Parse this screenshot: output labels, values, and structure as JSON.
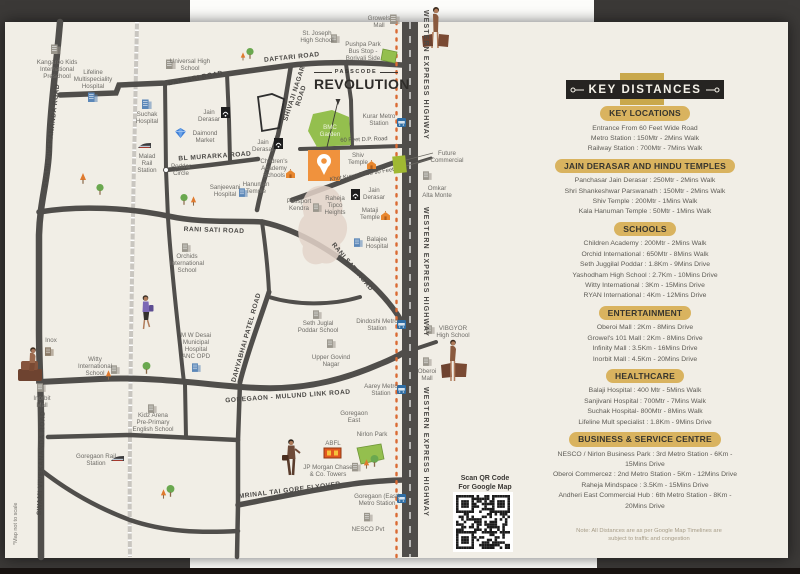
{
  "title": {
    "tagline": "PASSCODE",
    "name": "REVOLUTION"
  },
  "ribbon": {
    "title": "KEY DISTANCES"
  },
  "qr": {
    "caption_line1": "Scan QR Code",
    "caption_line2": "For Google Map"
  },
  "colors": {
    "page": "#f1eee6",
    "road": "#504e4b",
    "accent_gold": "#d9b35f",
    "ribbon_black": "#262422",
    "site_orange": "#f0923d",
    "highway_dots": "#da6a33",
    "park_green": "#94bf4e",
    "metro_blue": "#2e6da4"
  },
  "panel": {
    "sections": [
      {
        "title": "KEY LOCATIONS",
        "items": [
          "Entrance From 60 Feet Wide Road",
          "Metro Station : 150Mtr - 2Mins Walk",
          "Railway Station : 700Mtr - 7Mins Walk"
        ]
      },
      {
        "title": "JAIN DERASAR AND HINDU TEMPLES",
        "items": [
          "Panchasar Jain Derasar : 250Mtr - 2Mins Walk",
          "Shri Shankeshwar Parswanath : 150Mtr - 2Mins Walk",
          "Shiv Temple : 200Mtr - 1Mins Walk",
          "Kala Hanuman Temple : 50Mtr - 1Mins Walk"
        ]
      },
      {
        "title": "SCHOOLS",
        "items": [
          "Children Academy : 200Mtr - 2Mins Walk",
          "Orchid International : 650Mtr - 8Mins Walk",
          "Seth Juggilal Poddar : 1.8Km - 9Mins Drive",
          "Yashodham High School : 2.7Km - 10Mins Drive",
          "Witty International : 3Km - 15Mins Drive",
          "RYAN International : 4Km - 12Mins Drive"
        ]
      },
      {
        "title": "ENTERTAINMENT",
        "items": [
          "Oberoi Mall : 2Km - 8Mins Drive",
          "Growel's 101 Mall : 2Km - 8Mins Drive",
          "Infinity Mall : 3.5Km - 16Mins Drive",
          "Inorbit Mall : 4.5Km - 20Mins Drive"
        ]
      },
      {
        "title": "HEALTHCARE",
        "items": [
          "Balaji Hospital : 400 Mtr - 5Mins Walk",
          "Sanjivani Hospital : 700Mtr - 7Mins Walk",
          "Suchak Hospital- 800Mtr - 8Mins Walk",
          "Lifeline Mult specialist : 1.8Km - 9Mins Drive"
        ]
      },
      {
        "title": "BUSINESS & SERVICE CENTRE",
        "items": [
          "NESCO / Nirlon Business Park : 3rd Metro Station - 6Km - 15Mins Drive",
          "Oberoi Commercez : 2nd Metro Station - 5Km - 12Mins Drive",
          "Raheja Mindspace : 3.5Km - 15Mins Drive",
          "Andheri East Commercial Hub : 6th Metro Station - 8Km - 20Mins Drive"
        ]
      }
    ],
    "note_line1": "Note: All Distances are as per Google Map Timelines are",
    "note_line2": "subject to traffic and congestion"
  },
  "map": {
    "disclaimer": "*Map not to scale",
    "labels": [
      {
        "t": "SWAMI VIVEKANANDA ROAD",
        "x": 53,
        "y": 136,
        "r": -83,
        "c": "road"
      },
      {
        "t": "SWAMI VIVEKANANDA ROAD",
        "x": 43,
        "y": 463,
        "r": -88,
        "c": "road"
      },
      {
        "t": "DAFTARI ROAD",
        "x": 196,
        "y": 80,
        "r": -11,
        "c": "road"
      },
      {
        "t": "DAFTARI ROAD",
        "x": 292,
        "y": 59,
        "r": -6,
        "c": "road"
      },
      {
        "t": "BL MURARKA ROAD",
        "x": 215,
        "y": 158,
        "r": -4,
        "c": "road"
      },
      {
        "t": "SHIVAJI NAGAR\nROAD",
        "x": 296,
        "y": 94,
        "r": -72,
        "c": "road"
      },
      {
        "t": "RANI SATI ROAD",
        "x": 214,
        "y": 232,
        "r": 2,
        "c": "road"
      },
      {
        "t": "RANI SATI ROAD",
        "x": 351,
        "y": 268,
        "r": 50,
        "c": "road"
      },
      {
        "t": "DAHYABHAI PATEL ROAD",
        "x": 248,
        "y": 338,
        "r": -74,
        "c": "road"
      },
      {
        "t": "GOREGAON - MULUND LINK ROAD",
        "x": 288,
        "y": 398,
        "r": -4,
        "c": "road"
      },
      {
        "t": "MRINAL TAI GORE FLYOVER",
        "x": 290,
        "y": 492,
        "r": -7,
        "c": "road"
      },
      {
        "t": "WESTERN EXPRESS HIGHWAY",
        "x": 424,
        "y": 75,
        "r": 90,
        "c": "hwy"
      },
      {
        "t": "WESTERN EXPRESS HIGHWAY",
        "x": 424,
        "y": 272,
        "r": 90,
        "c": "hwy"
      },
      {
        "t": "WESTERN EXPRESS HIGHWAY",
        "x": 424,
        "y": 452,
        "r": 90,
        "c": "hwy"
      },
      {
        "t": "60 Feet D.P. Road",
        "x": 364,
        "y": 141,
        "r": -2,
        "c": "place2"
      },
      {
        "t": "Khot Kuwa Raod 90 Feet",
        "x": 362,
        "y": 176,
        "r": -9,
        "c": "place2"
      },
      {
        "t": "Kangaroo Kids\nInternational\nPreschool",
        "x": 57,
        "y": 64
      },
      {
        "t": "Lifeline\nMultispeciality\nHospital",
        "x": 93,
        "y": 74
      },
      {
        "t": "Universal High\nSchool",
        "x": 190,
        "y": 63
      },
      {
        "t": "Suchak\nHospital",
        "x": 147,
        "y": 116
      },
      {
        "t": "Malad\nRail\nStation",
        "x": 147,
        "y": 158
      },
      {
        "t": "Jain\nDerasar",
        "x": 209,
        "y": 114
      },
      {
        "t": "Daimond\nMarket",
        "x": 205,
        "y": 135
      },
      {
        "t": "Poddar\nCircle",
        "x": 181,
        "y": 168
      },
      {
        "t": "Sanjeevani\nHospital",
        "x": 225,
        "y": 189
      },
      {
        "t": "Orchids\nInternational\nSchool",
        "x": 187,
        "y": 258
      },
      {
        "t": "Inox",
        "x": 51,
        "y": 342
      },
      {
        "t": "Witty\nInternational\nSchool",
        "x": 95,
        "y": 361
      },
      {
        "t": "Inorbit\nMall",
        "x": 42,
        "y": 400
      },
      {
        "t": "M W Desai\nMunicipal\nHospital\nANC OPD",
        "x": 196,
        "y": 337
      },
      {
        "t": "Kidz Arena\nPre-Primary\nEnglish School",
        "x": 153,
        "y": 417
      },
      {
        "t": "Goregaon Rail\nStation",
        "x": 96,
        "y": 458
      },
      {
        "t": "Growels\nMall",
        "x": 379,
        "y": 20
      },
      {
        "t": "St. Joseph\nHigh School",
        "x": 317,
        "y": 35
      },
      {
        "t": "Pushpa Park\nBus Stop -\nBorivali Side",
        "x": 363,
        "y": 46
      },
      {
        "t": "Kurar Metro\nStation",
        "x": 379,
        "y": 118
      },
      {
        "t": "BMC\nGarden",
        "x": 330,
        "y": 129,
        "c": "green"
      },
      {
        "t": "Jain\nDerasar",
        "x": 263,
        "y": 144
      },
      {
        "t": "Children's\nAcademy\nSchools",
        "x": 274,
        "y": 163
      },
      {
        "t": "Shiv\nTemple",
        "x": 358,
        "y": 157
      },
      {
        "t": "Hanuman\nTemple",
        "x": 256,
        "y": 186
      },
      {
        "t": "Jain\nDerasar",
        "x": 374,
        "y": 192
      },
      {
        "t": "Future\nCommercial",
        "x": 447,
        "y": 155
      },
      {
        "t": "Omkar\nAlta Monte",
        "x": 437,
        "y": 190
      },
      {
        "t": "Passport\nKendra",
        "x": 299,
        "y": 203
      },
      {
        "t": "Raheja\nTipco\nHeights",
        "x": 335,
        "y": 200
      },
      {
        "t": "Mataji\nTemple",
        "x": 370,
        "y": 212
      },
      {
        "t": "Balajee\nHospital",
        "x": 377,
        "y": 241
      },
      {
        "t": "Seth Juglal\nPoddar School",
        "x": 318,
        "y": 325
      },
      {
        "t": "Dindoshi Metro\nStation",
        "x": 377,
        "y": 323
      },
      {
        "t": "VIBGYOR\nHigh School",
        "x": 453,
        "y": 330
      },
      {
        "t": "Upper Govind\nNagar",
        "x": 331,
        "y": 359
      },
      {
        "t": "Oberoi\nMall",
        "x": 427,
        "y": 373
      },
      {
        "t": "Aarey Metro\nStation",
        "x": 381,
        "y": 388
      },
      {
        "t": "Goregaon\nEast",
        "x": 354,
        "y": 415
      },
      {
        "t": "Nirlon Park",
        "x": 372,
        "y": 436
      },
      {
        "t": "ABFL",
        "x": 333,
        "y": 445
      },
      {
        "t": "JP Morgan Chase\n& Co. Towers",
        "x": 328,
        "y": 469
      },
      {
        "t": "Goregaon (East)\nMetro Station",
        "x": 377,
        "y": 498
      },
      {
        "t": "NESCO Pvt",
        "x": 368,
        "y": 531
      }
    ]
  }
}
